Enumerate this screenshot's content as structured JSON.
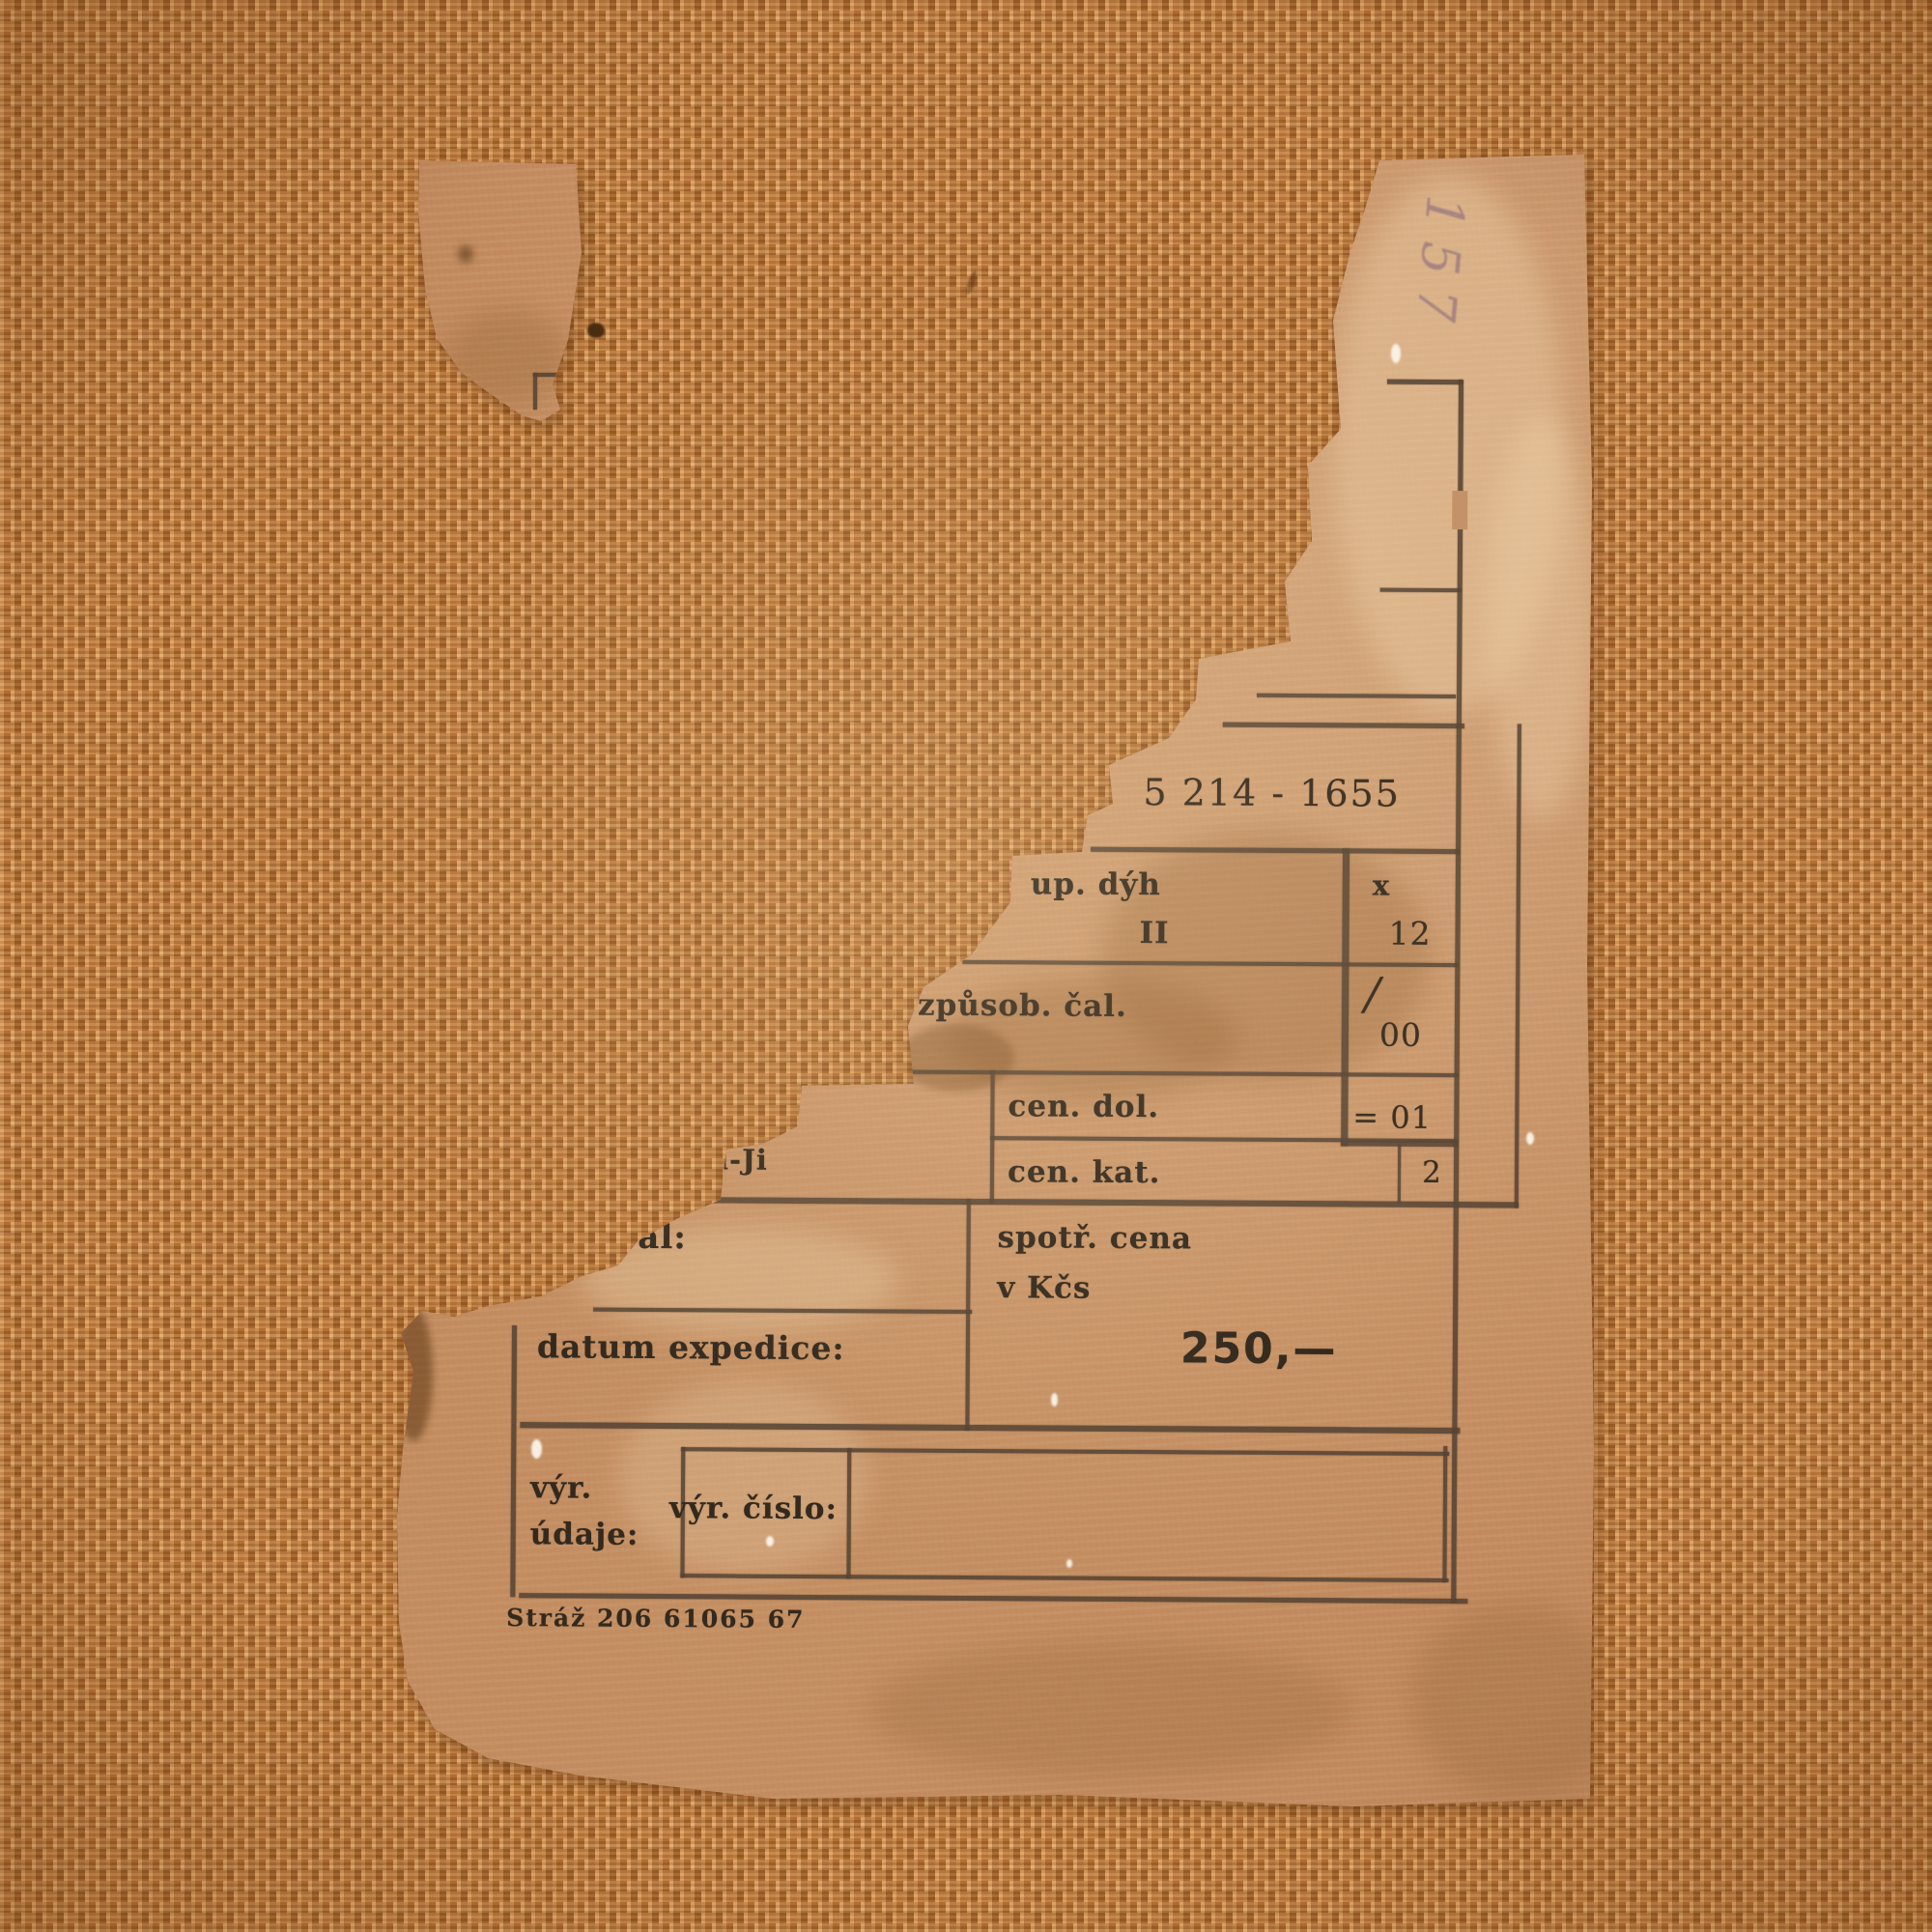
{
  "colors": {
    "burlap": "#c07a3c",
    "paper": "#c69a6e",
    "ink": "#33291e",
    "pencil": "#80607c",
    "white_speck": "#faf4e9"
  },
  "label": {
    "pencil_number": "157",
    "model_number": "5 214 - 1655",
    "cells": {
      "dyh_label": "up. dýh",
      "dyh_value": "II",
      "dyh_mark": "x",
      "dyh_code": "12",
      "cal_label": "způsob. čal.",
      "cal_slash": "/",
      "cal_code": "00",
      "cen_dol_label": "cen. dol.",
      "cen_dol_code": "= 01",
      "torn_fragment_text": "l-Ji",
      "cen_kat_label": "cen. kat.",
      "cen_kat_code": "2",
      "val_label": "val:",
      "price_label_line1": "spotř. cena",
      "price_label_line2": "v Kčs",
      "price_value": "250,—",
      "datum_label": "datum expedice:",
      "vyr_line1": "výr.",
      "vyr_line2": "údaje:",
      "vyr_cislo_label": "výr. číslo:"
    },
    "footer": "Stráž 206 61065 67"
  }
}
